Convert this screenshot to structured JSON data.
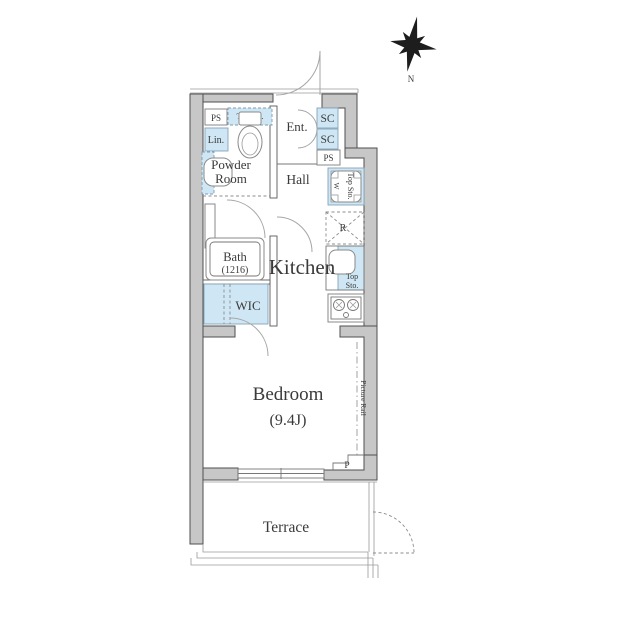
{
  "compass": {
    "north_label": "N"
  },
  "colors": {
    "wall_fill": "#c7c7c7",
    "wall_stroke": "#4f4f4f",
    "fixture_blue": "#cfe7f4",
    "fixture_stroke": "#84a3b8",
    "text_color": "#3a3a3a",
    "bg": "#ffffff"
  },
  "rooms": {
    "entrance": {
      "label": "Ent."
    },
    "hall": {
      "label": "Hall"
    },
    "powder_room": {
      "line1": "Powder",
      "line2": "Room"
    },
    "bath": {
      "label": "Bath",
      "size": "(1216)"
    },
    "kitchen": {
      "label": "Kitchen"
    },
    "wic": {
      "label": "WIC"
    },
    "bedroom": {
      "label": "Bedroom",
      "size": "(9.4J)"
    },
    "terrace": {
      "label": "Terrace"
    }
  },
  "fixtures": {
    "ps_top_left": "PS",
    "ps_mid_right": "PS",
    "top_storage_powder": "Top Sto.",
    "linen": "Lin.",
    "shoe_closet_upper": "SC",
    "shoe_closet_lower": "SC",
    "washer": "W",
    "top_storage_washer": "Top Sto.",
    "refrigerator": "R",
    "top_storage_kitchen_line1": "Top",
    "top_storage_kitchen_line2": "Sto.",
    "picture_rail": "Picture Rail",
    "pipe_space_bedroom": "P"
  }
}
